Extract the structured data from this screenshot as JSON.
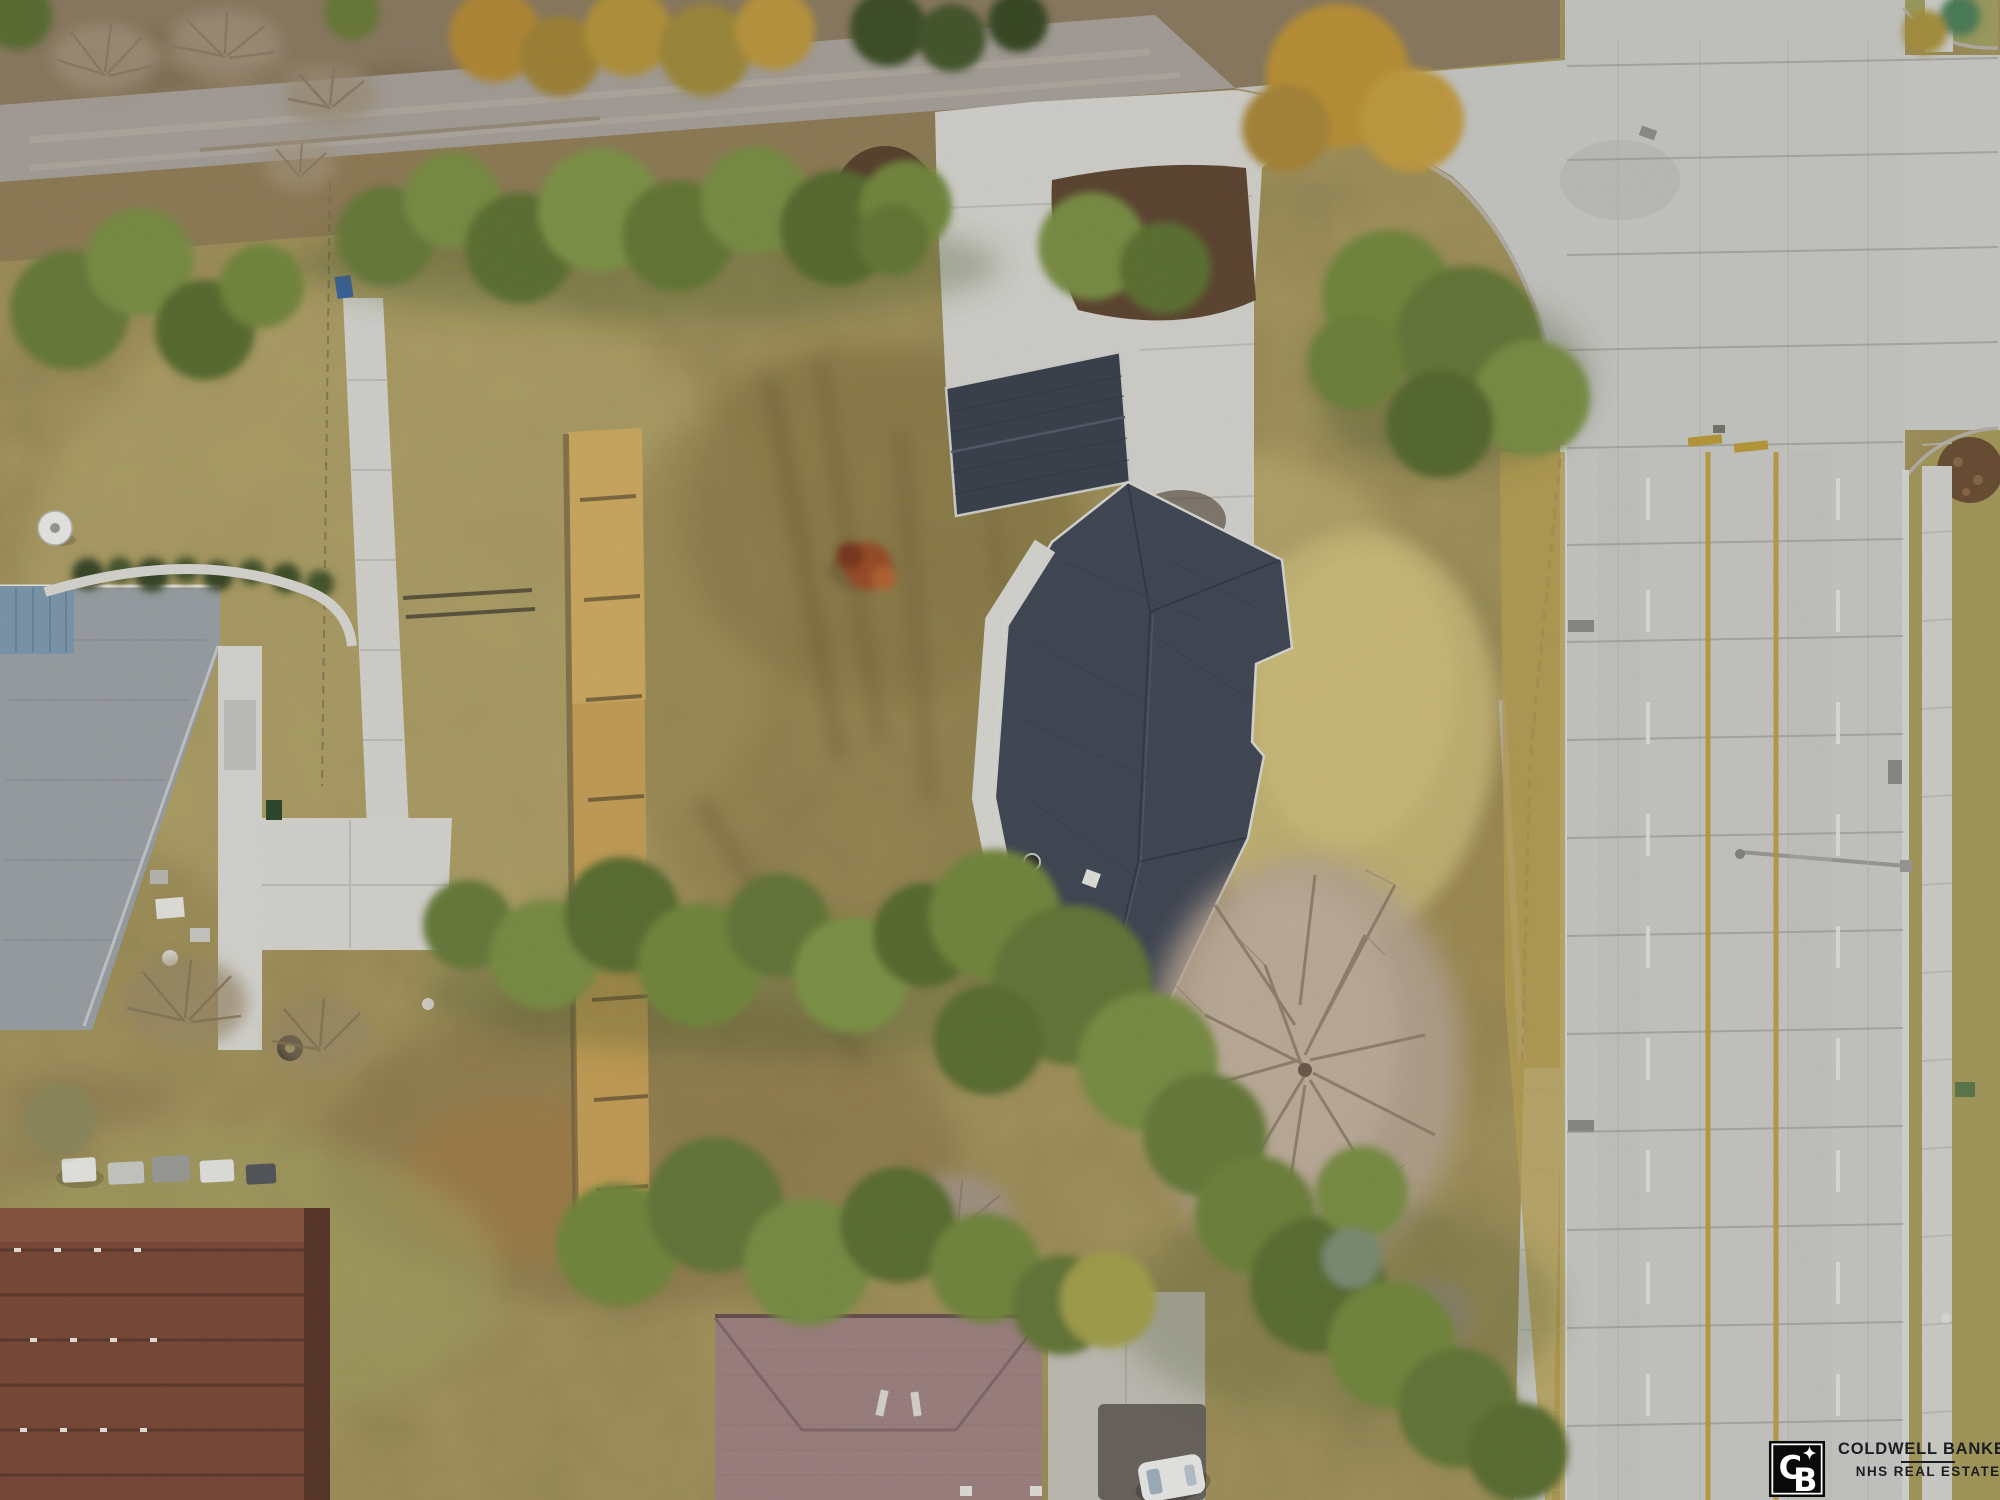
{
  "image": {
    "kind": "aerial-drone-photo",
    "description": "Top-down winter aerial of a large residential lot with a dark-roofed house and detached garage, tan dead grass, pine tree rows, a gravel road on top, a wide concrete arterial road with intersection on the right, neighboring houses left and bottom, real-estate watermark bottom right.",
    "width": 2000,
    "height": 1500
  },
  "watermark": {
    "brand_line1": "COLDWELL BANKER",
    "brand_line2": "NHS REAL ESTATE",
    "logo_monogram_c": "C",
    "logo_monogram_b": "B",
    "logo_star": "4-point star",
    "text_color": "#1c1c22",
    "logo_bg": "#0a0a0a",
    "logo_fg": "#ffffff"
  },
  "palette": {
    "field_tan": "#b1a166",
    "grass_gold": "#a59a5c",
    "scrub": "#8c7c62",
    "gravel": "#a6a099",
    "concrete": "#c7c7c4",
    "concrete_light": "#d3d2cd",
    "roof_dark": "#3d434f",
    "roof_dark2": "#434956",
    "roof_gray": "#9aa0a4",
    "roof_blue": "#7e98ad",
    "roof_mauve": "#9d8280",
    "roof_brown": "#7c4b39",
    "hedge_gold": "#c49f58",
    "mulch_brown": "#5a4430",
    "pine_green": "#6a7d3c",
    "bare_tree": "#b5a493",
    "marking_yellow": "#b99a3b",
    "marking_white": "#e3e3df"
  },
  "road": {
    "joint_ys": [
      66,
      160,
      255,
      350,
      448,
      545,
      642,
      740,
      838,
      936,
      1034,
      1132,
      1230,
      1328,
      1426
    ],
    "dash_xs": [
      1648,
      1838
    ],
    "yellow_line_xs": [
      1708,
      1776
    ],
    "long_joint_xs": [
      1618,
      1700,
      1788,
      1868
    ],
    "joint_color": "#9d9d99",
    "white": "#e3e3df",
    "yellow": "#b99a3b"
  },
  "vegetation": {
    "g-pines-top": [
      [
        70,
        310,
        60,
        "#6a7d3c"
      ],
      [
        140,
        262,
        54,
        "#7b9046"
      ],
      [
        205,
        330,
        50,
        "#5a6e33"
      ],
      [
        262,
        286,
        42,
        "#74893f"
      ],
      [
        386,
        236,
        50,
        "#6a7d3c"
      ],
      [
        452,
        200,
        48,
        "#7b9046"
      ],
      [
        520,
        248,
        55,
        "#5f7336"
      ],
      [
        600,
        210,
        62,
        "#7f954a"
      ],
      [
        678,
        236,
        56,
        "#667a39"
      ],
      [
        755,
        200,
        54,
        "#7b9046"
      ],
      [
        838,
        228,
        58,
        "#5a6e33"
      ],
      [
        906,
        206,
        46,
        "#74893f"
      ],
      [
        893,
        240,
        36,
        "#667a39"
      ],
      [
        1092,
        246,
        54,
        "#7b9046"
      ],
      [
        1165,
        268,
        46,
        "#5f7336"
      ],
      [
        1388,
        296,
        66,
        "#74893f"
      ],
      [
        1468,
        338,
        72,
        "#66793a"
      ],
      [
        1532,
        398,
        58,
        "#7b9046"
      ],
      [
        1440,
        424,
        54,
        "#586c32"
      ],
      [
        1356,
        362,
        48,
        "#6f843d"
      ]
    ],
    "g-pines-bottom": [
      [
        468,
        925,
        45,
        "#6a7d3c"
      ],
      [
        545,
        955,
        55,
        "#7b9046"
      ],
      [
        622,
        915,
        58,
        "#5d7134"
      ],
      [
        700,
        965,
        62,
        "#74893f"
      ],
      [
        778,
        925,
        52,
        "#66793a"
      ],
      [
        852,
        975,
        58,
        "#7f954a"
      ],
      [
        925,
        935,
        52,
        "#5a6e33"
      ],
      [
        995,
        915,
        66,
        "#74893f"
      ],
      [
        1072,
        985,
        80,
        "#66793a"
      ],
      [
        1148,
        1062,
        70,
        "#7b9046"
      ],
      [
        988,
        1040,
        55,
        "#5d7134"
      ],
      [
        1205,
        1135,
        62,
        "#6a7d3c"
      ],
      [
        618,
        1245,
        62,
        "#74893f"
      ],
      [
        715,
        1205,
        68,
        "#66793a"
      ],
      [
        808,
        1262,
        64,
        "#7b9046"
      ],
      [
        898,
        1225,
        58,
        "#5d7134"
      ],
      [
        985,
        1268,
        55,
        "#74893f"
      ],
      [
        1062,
        1305,
        50,
        "#66793a"
      ],
      [
        1255,
        1215,
        60,
        "#6f843d"
      ],
      [
        1318,
        1285,
        68,
        "#5d7134"
      ],
      [
        1392,
        1345,
        64,
        "#74893f"
      ],
      [
        1458,
        1408,
        60,
        "#66793a"
      ],
      [
        1362,
        1192,
        46,
        "#7b9046"
      ],
      [
        1518,
        1452,
        50,
        "#5d7134"
      ],
      [
        1108,
        1300,
        48,
        "#a3a04e"
      ],
      [
        1352,
        1258,
        30,
        "#7e8e74"
      ],
      [
        60,
        1120,
        36,
        "#8f8a5e"
      ]
    ],
    "g-scrub-trees": [
      [
        495,
        36,
        46,
        "#b28a39"
      ],
      [
        560,
        56,
        40,
        "#a08438"
      ],
      [
        628,
        32,
        44,
        "#b3943e"
      ],
      [
        705,
        50,
        46,
        "#9f8a3d"
      ],
      [
        775,
        30,
        40,
        "#bb9740"
      ],
      [
        888,
        28,
        38,
        "#3f5129"
      ],
      [
        952,
        38,
        34,
        "#46592e"
      ],
      [
        1018,
        22,
        30,
        "#3a4c26"
      ],
      [
        1338,
        76,
        72,
        "#bb9339"
      ],
      [
        1412,
        120,
        52,
        "#c19c42"
      ],
      [
        1286,
        128,
        44,
        "#a8873a"
      ],
      [
        18,
        16,
        34,
        "#5d6f36"
      ],
      [
        352,
        12,
        28,
        "#6c7d3d"
      ],
      [
        1960,
        16,
        20,
        "#4e7f5a"
      ],
      [
        1925,
        32,
        22,
        "#a8923f"
      ]
    ]
  },
  "scene_objects": [
    {
      "name": "subject-house",
      "desc": "angled dark shingle roof with white porch awning"
    },
    {
      "name": "detached-garage",
      "desc": "dark shingle roof on concrete driveway"
    },
    {
      "name": "gravel-road",
      "desc": "dirt gravel road along top"
    },
    {
      "name": "arterial-road",
      "desc": "concrete multi-lane road with double yellow centerlines"
    },
    {
      "name": "intersection",
      "desc": "side street entering from right"
    },
    {
      "name": "left-house",
      "desc": "gray hip roof with blue metal patio cover and satellite dish"
    },
    {
      "name": "mauve-house",
      "desc": "mauve hip roof at bottom center"
    },
    {
      "name": "brown-building",
      "desc": "brown shingle multi-unit roof bottom left"
    },
    {
      "name": "white-car",
      "desc": "white car parked at bottom"
    },
    {
      "name": "reed-hedge",
      "desc": "dried golden reed hedge line"
    },
    {
      "name": "big-bare-tree",
      "desc": "large leafless tree, silvery branches"
    },
    {
      "name": "pine-rows",
      "desc": "rows of green pines bordering lot"
    }
  ]
}
